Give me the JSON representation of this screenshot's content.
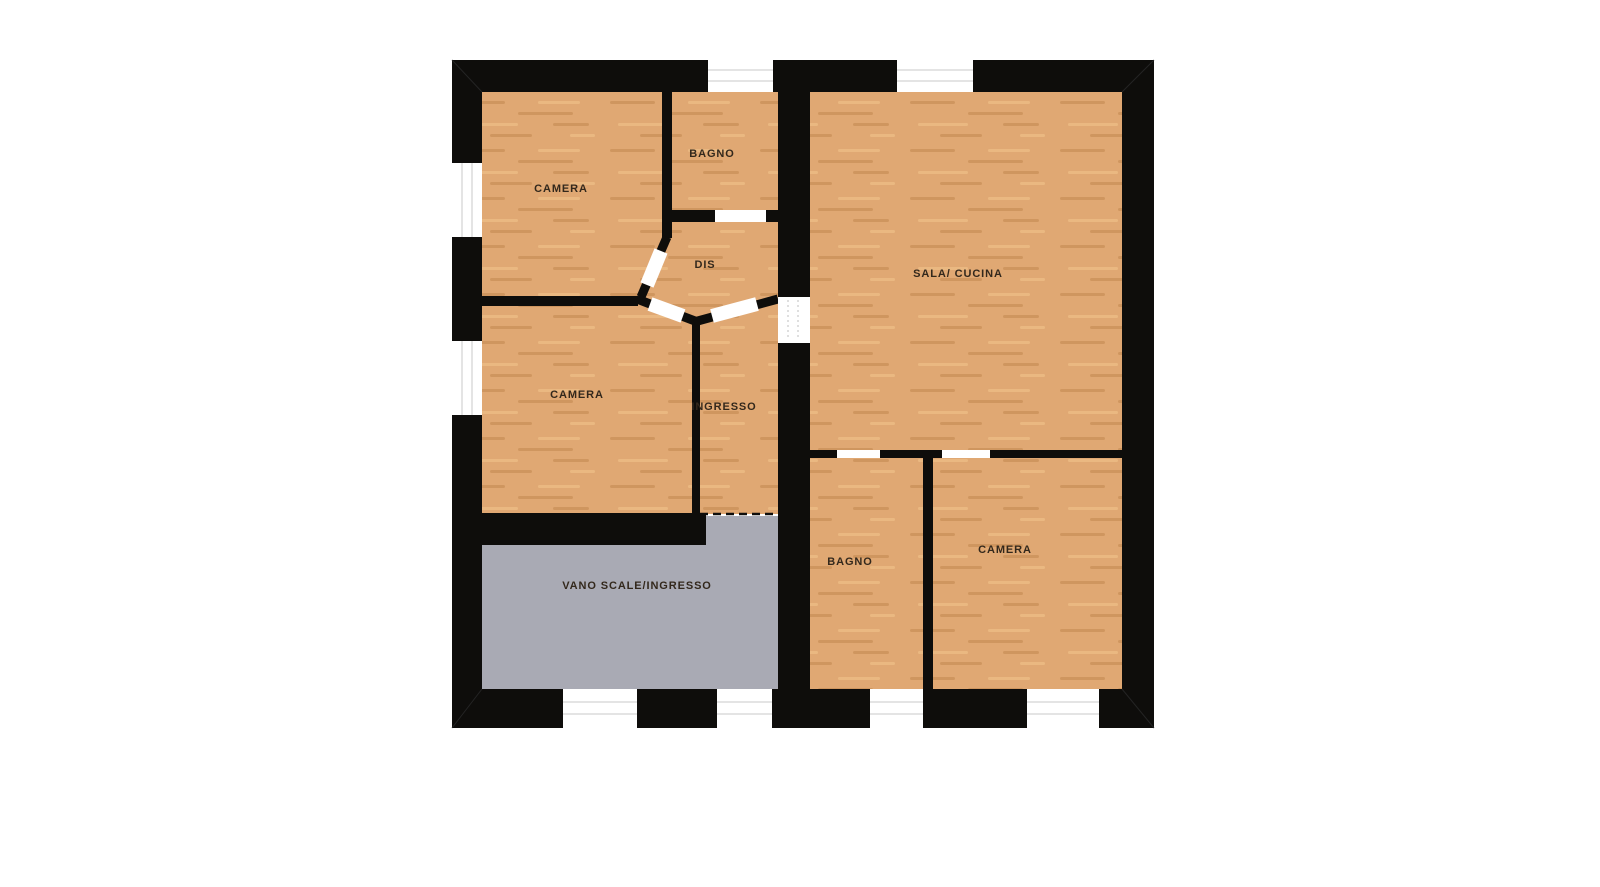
{
  "plan": {
    "rooms": [
      {
        "id": "camera-nw",
        "label": "CAMERA"
      },
      {
        "id": "bagno-top",
        "label": "BAGNO"
      },
      {
        "id": "dis",
        "label": "DIS"
      },
      {
        "id": "sala-cucina",
        "label": "SALA/ CUCINA"
      },
      {
        "id": "camera-w",
        "label": "CAMERA"
      },
      {
        "id": "ingresso",
        "label": "INGRESSO"
      },
      {
        "id": "vano-scale-ingresso",
        "label": "VANO SCALE/INGRESSO"
      },
      {
        "id": "bagno-s",
        "label": "BAGNO"
      },
      {
        "id": "camera-se",
        "label": "CAMERA"
      }
    ],
    "colors": {
      "background": "#ffffff",
      "wall": "#0e0d0b",
      "wood_base": "#e0a873",
      "wood_dark": "#bb8148",
      "wood_light": "#f1c58c",
      "stair_floor": "#a9aab4",
      "label_text": "#33281c",
      "window_line": "#c9c9c9"
    }
  }
}
